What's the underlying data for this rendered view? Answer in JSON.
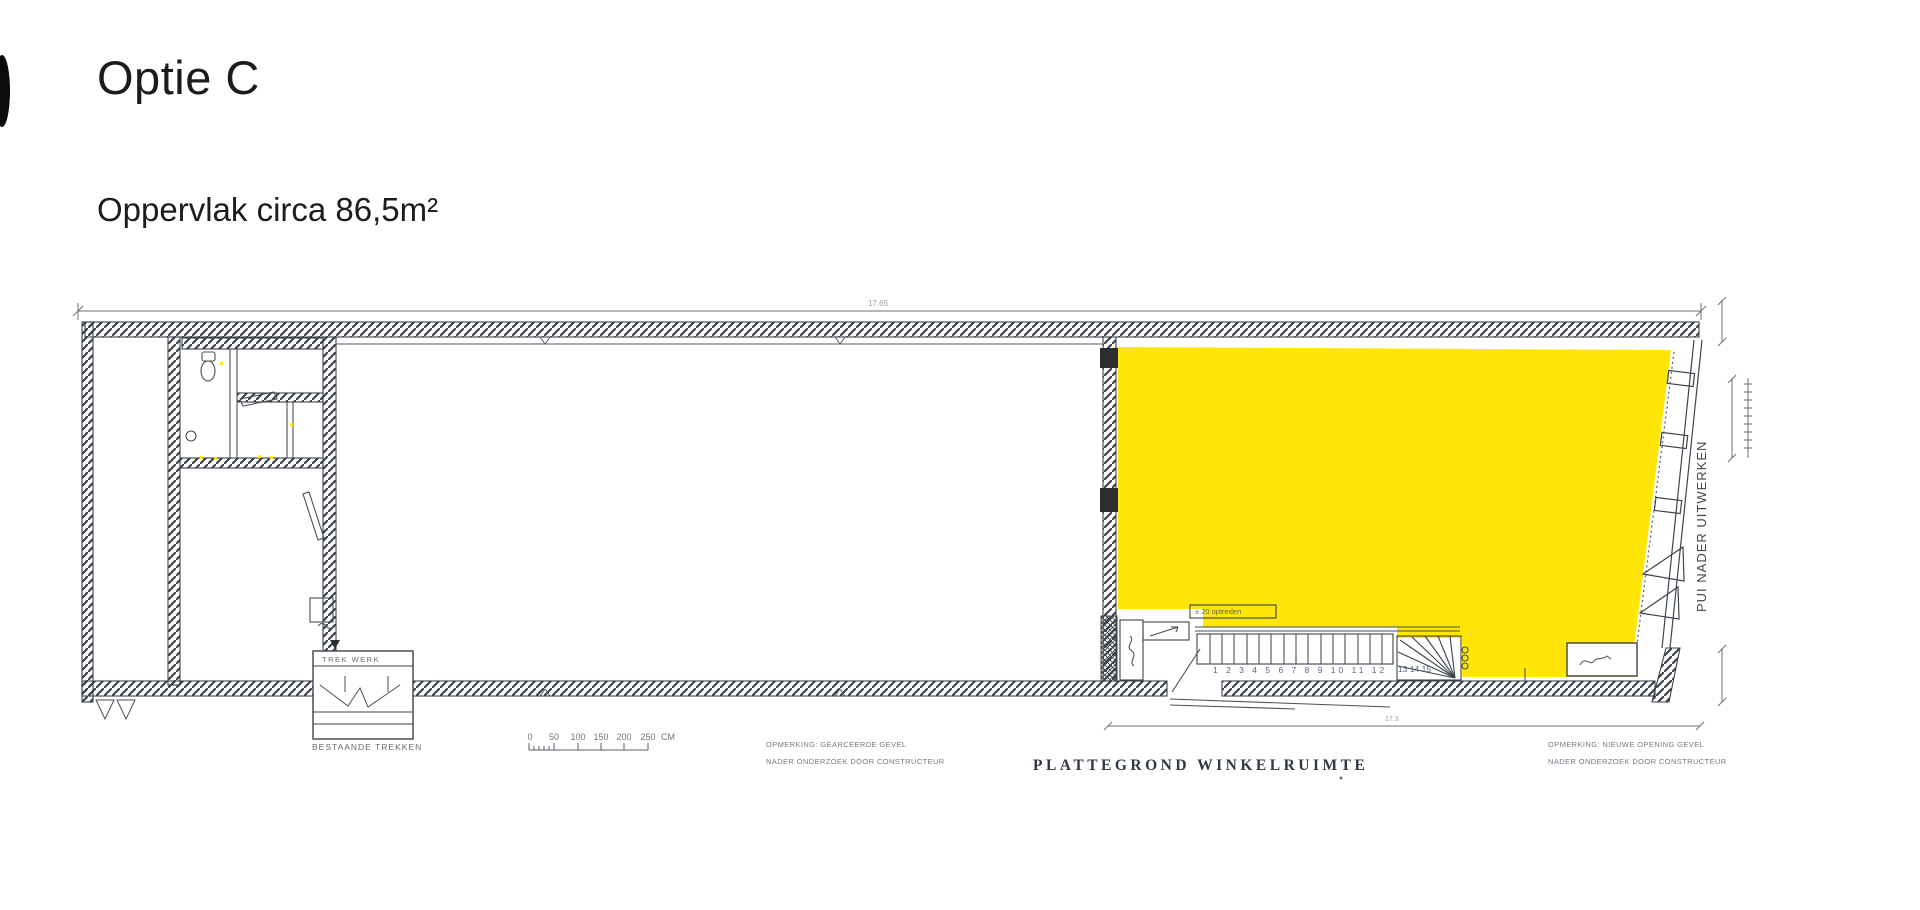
{
  "page": {
    "title": "Optie C",
    "subtitle": "Oppervlak circa 86,5m²"
  },
  "plan": {
    "caption": "PLATTEGROND WINKELRUIMTE",
    "highlight_color": "#ffe607",
    "dim_top": "17.65",
    "dim_bottom": "17.3",
    "scale": {
      "ticks": [
        "0",
        "50",
        "100",
        "150",
        "200",
        "250"
      ],
      "unit": "CM"
    },
    "labels": {
      "trek_box": "TREK WERK",
      "bestaande": "BESTAANDE TREKKEN",
      "stair_note": "± 20 optreden",
      "stair_numbers": "1 2 3 4 5 6 7 8 9 10 11 12",
      "stair_numbers_winder": "13 14 15",
      "pui": "PUI NADER UITWERKEN"
    },
    "notes_left": {
      "line1": "OPMERKING: GEARCEERDE GEVEL",
      "line2": "NADER ONDERZOEK DOOR CONSTRUCTEUR"
    },
    "notes_right": {
      "line1": "OPMERKING: NIEUWE OPENING GEVEL",
      "line2": "NADER ONDERZOEK DOOR CONSTRUCTEUR"
    }
  }
}
